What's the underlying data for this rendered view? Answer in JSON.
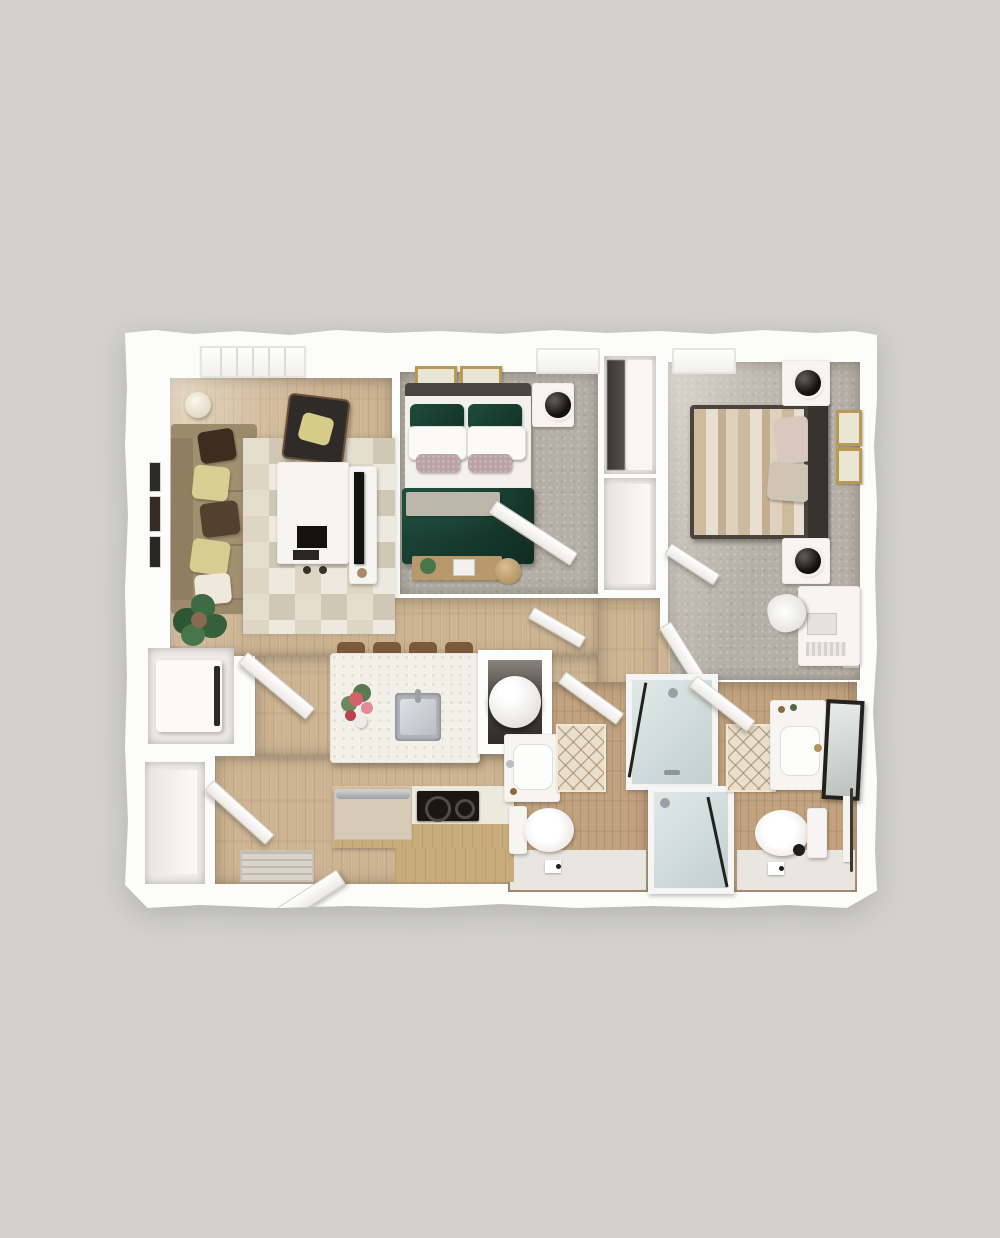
{
  "scene": {
    "type": "floor-plan-3d-render",
    "title": "Two-bedroom, two-bath apartment floor plan (top-down 3D render)",
    "background_color": "#d2d1cf",
    "paper_color": "#fcfcfb"
  },
  "palette": {
    "bg": "#d2d1cf",
    "paper": "#fcfcfb",
    "wood": "#cdb492",
    "woodBath": "#c2a37f",
    "carpet": "#b5b0a7",
    "rugBase": "#eae5d8",
    "rugTri": "#cfc8b6",
    "matBase": "#eadfca",
    "furnWhite": "#f6f5f2",
    "green": "#1c4639",
    "greenDeep": "#123226",
    "sofa": "#a29170",
    "cabinet": "#c8ab7b",
    "gold": "#b99a55",
    "steel": "#b9bec3",
    "darkFurn": "#413c38"
  },
  "rooms": [
    {
      "name": "Living Room",
      "furniture": [
        "window",
        "sofa",
        "throw-pillows",
        "wall-art",
        "floor-lamp",
        "accent-chair",
        "geometric-rug",
        "coffee-table",
        "tv-console",
        "floor-plant"
      ]
    },
    {
      "name": "Bedroom 1",
      "furniture": [
        "window",
        "green-bed",
        "headboard",
        "wall-art",
        "nightstand",
        "sphere-lamp",
        "bench",
        "door"
      ]
    },
    {
      "name": "Bedroom 2",
      "furniture": [
        "window",
        "striped-bed",
        "headboard",
        "nightstands",
        "sphere-lamps",
        "wall-art",
        "desk",
        "desk-chair",
        "closet-door",
        "door"
      ]
    },
    {
      "name": "Kitchen",
      "furniture": [
        "island",
        "bar-stools",
        "sink",
        "flowers",
        "oven",
        "cooktop",
        "cabinets",
        "water-heater-closet"
      ]
    },
    {
      "name": "Laundry Closet",
      "furniture": [
        "washer-dryer",
        "closet-door"
      ]
    },
    {
      "name": "Entry",
      "furniture": [
        "entry-door",
        "doormat",
        "linen-closet"
      ]
    },
    {
      "name": "Bathroom 1",
      "furniture": [
        "vanity-sink",
        "bath-mat",
        "toilet",
        "walk-in-shower",
        "toilet-paper-holder",
        "door"
      ]
    },
    {
      "name": "Bathroom 2",
      "furniture": [
        "vanity-sink",
        "leaning-mirror",
        "bath-mat",
        "toilet",
        "walk-in-shower",
        "wood-shelf",
        "towel-bar",
        "toilet-paper-holder",
        "door"
      ]
    },
    {
      "name": "Hallway",
      "furniture": []
    },
    {
      "name": "Bedroom 2 Closet",
      "furniture": [
        "hanging-clothes",
        "shelving"
      ]
    }
  ]
}
